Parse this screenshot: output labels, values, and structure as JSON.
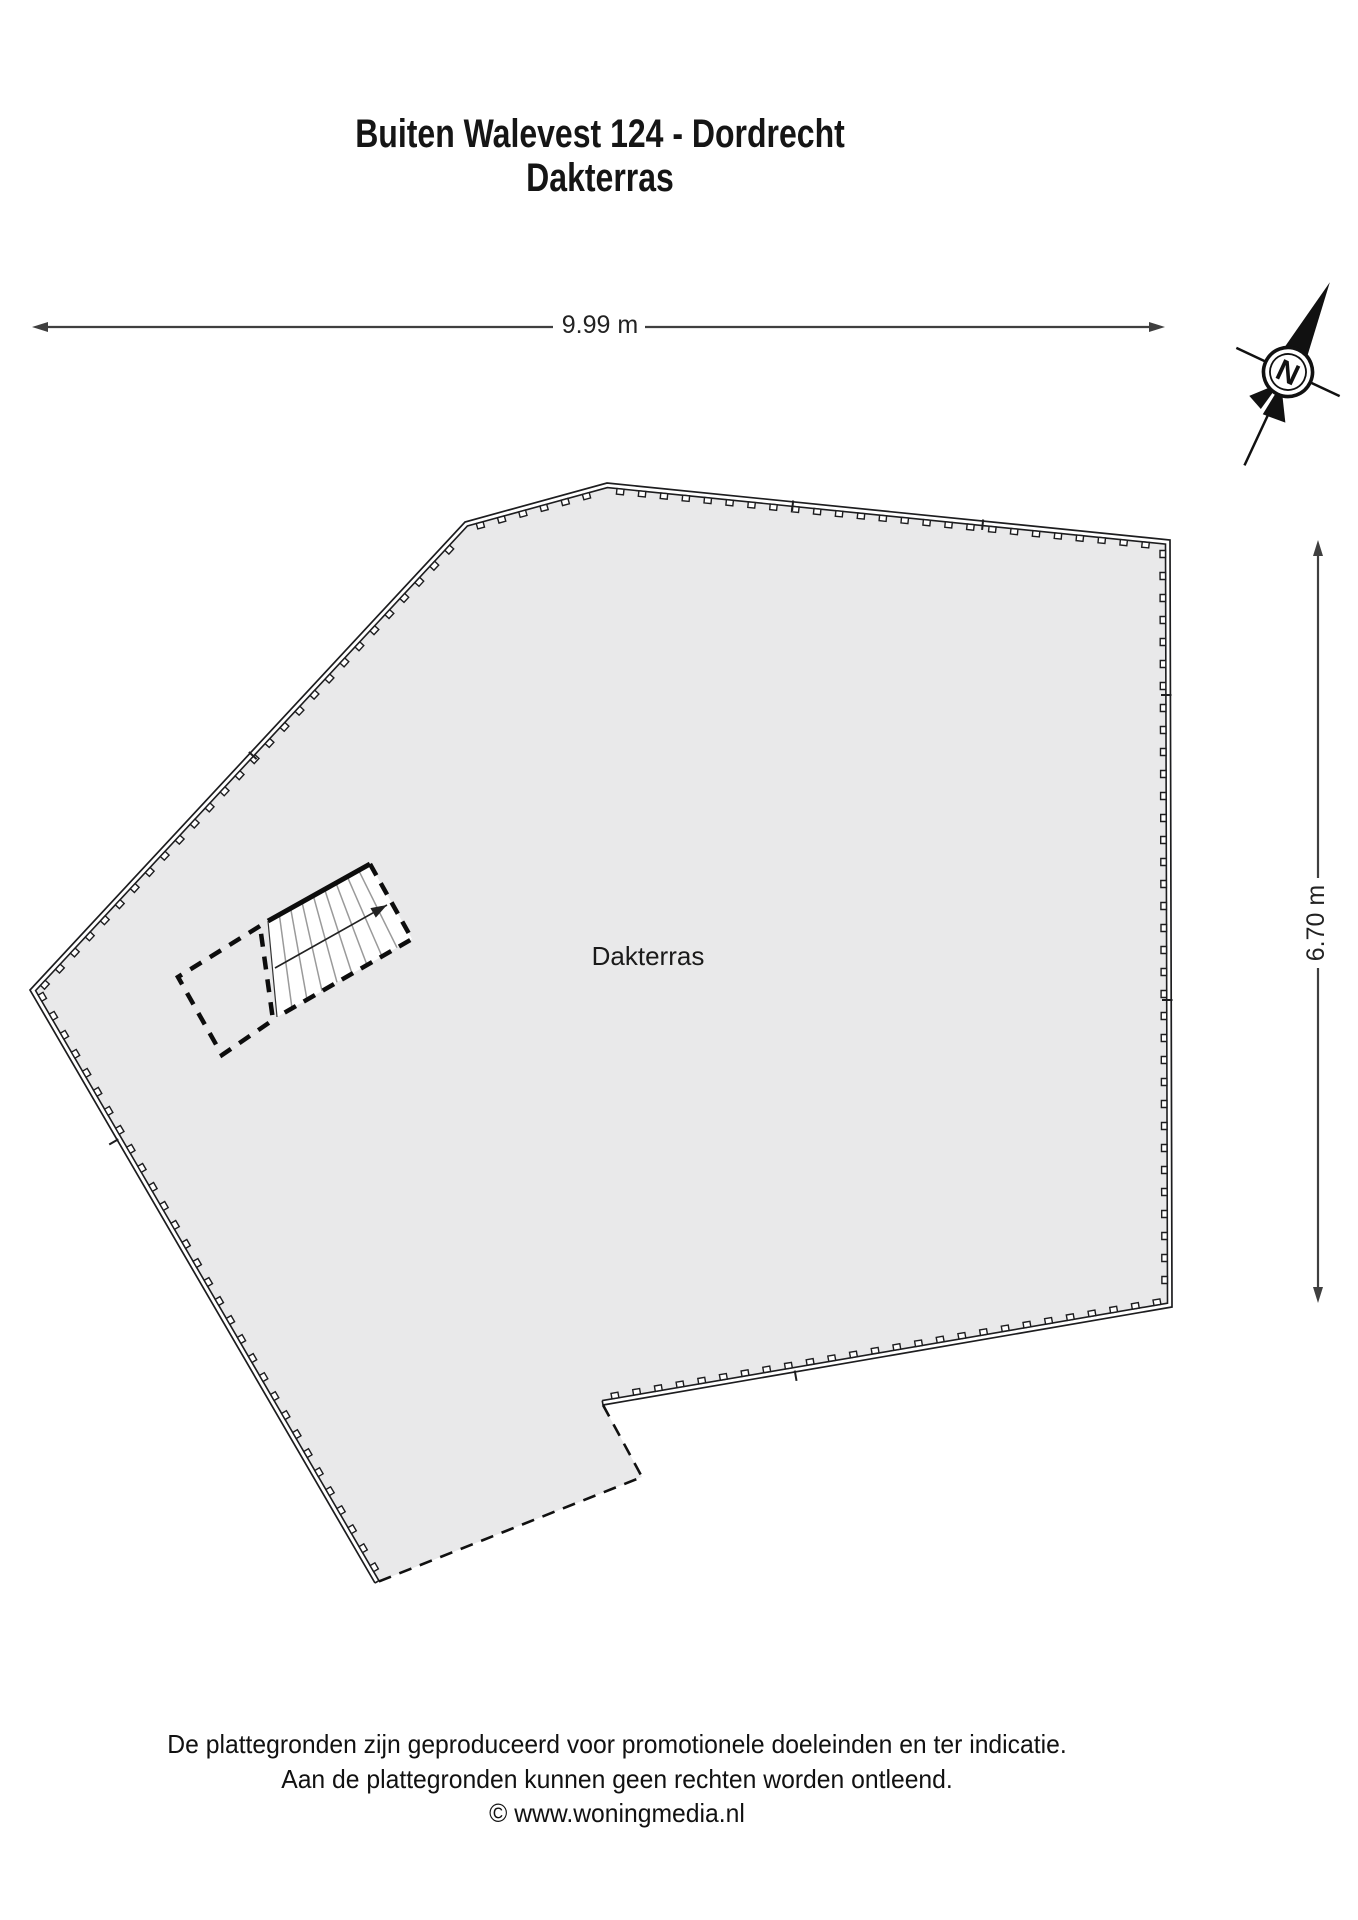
{
  "title": {
    "line1": "Buiten Walevest 124 - Dordrecht",
    "line2": "Dakterras"
  },
  "room": {
    "label": "Dakterras"
  },
  "dimensions": {
    "horizontal": {
      "label": "9.99 m",
      "y": 327,
      "x1": 32,
      "x2": 1165,
      "gap": [
        553,
        645
      ]
    },
    "vertical": {
      "label": "6.70 m",
      "x": 1318,
      "y1": 540,
      "y2": 1303,
      "gap": [
        878,
        968
      ]
    }
  },
  "compass": {
    "letter": "N",
    "cx": 1288,
    "cy": 372,
    "rotation": 25
  },
  "colors": {
    "floor_fill": "#e9e9ea",
    "outline": "#1d1d1f",
    "dimension": "#3f3f3f",
    "tread": "#9a9a9a",
    "white": "#ffffff"
  },
  "floorplan": {
    "outline": [
      [
        607,
        483
      ],
      [
        1170,
        540
      ],
      [
        1172,
        1307
      ],
      [
        603,
        1405
      ],
      [
        642,
        1477
      ],
      [
        375,
        1583
      ],
      [
        30,
        990
      ],
      [
        465,
        522
      ]
    ],
    "solid_chain": [
      5,
      6,
      7,
      0,
      1,
      2,
      3
    ],
    "dashed_chain": [
      3,
      4,
      5
    ],
    "band_width": 4.5,
    "teeth": {
      "spacing": 22,
      "len": 7,
      "depth": 5.5,
      "offset": 7.3
    },
    "dividers": [
      {
        "p": [
          793,
          502
        ],
        "a": 5.8
      },
      {
        "p": [
          983,
          521
        ],
        "a": 5.8
      },
      {
        "p": [
          1170,
          695
        ],
        "a": 90
      },
      {
        "p": [
          1171,
          1000
        ],
        "a": 90
      },
      {
        "p": [
          795,
          1372
        ],
        "a": -9.8
      },
      {
        "p": [
          117,
          1140
        ],
        "a": 59.8
      },
      {
        "p": [
          250,
          753
        ],
        "a": -47.1
      }
    ],
    "stair": {
      "poly": [
        [
          268,
          921
        ],
        [
          370,
          864
        ],
        [
          412,
          939
        ],
        [
          277,
          1017
        ]
      ],
      "treads": 8,
      "arrow": [
        [
          275,
          968
        ],
        [
          387,
          905
        ]
      ]
    },
    "landing": [
      [
        260,
        926
      ],
      [
        178,
        977
      ],
      [
        222,
        1055
      ],
      [
        273,
        1020
      ]
    ]
  },
  "footer": {
    "lines": [
      "De plattegronden zijn geproduceerd voor promotionele doeleinden en ter indicatie.",
      "Aan de plattegronden kunnen geen rechten worden ontleend.",
      "© www.woningmedia.nl"
    ]
  }
}
